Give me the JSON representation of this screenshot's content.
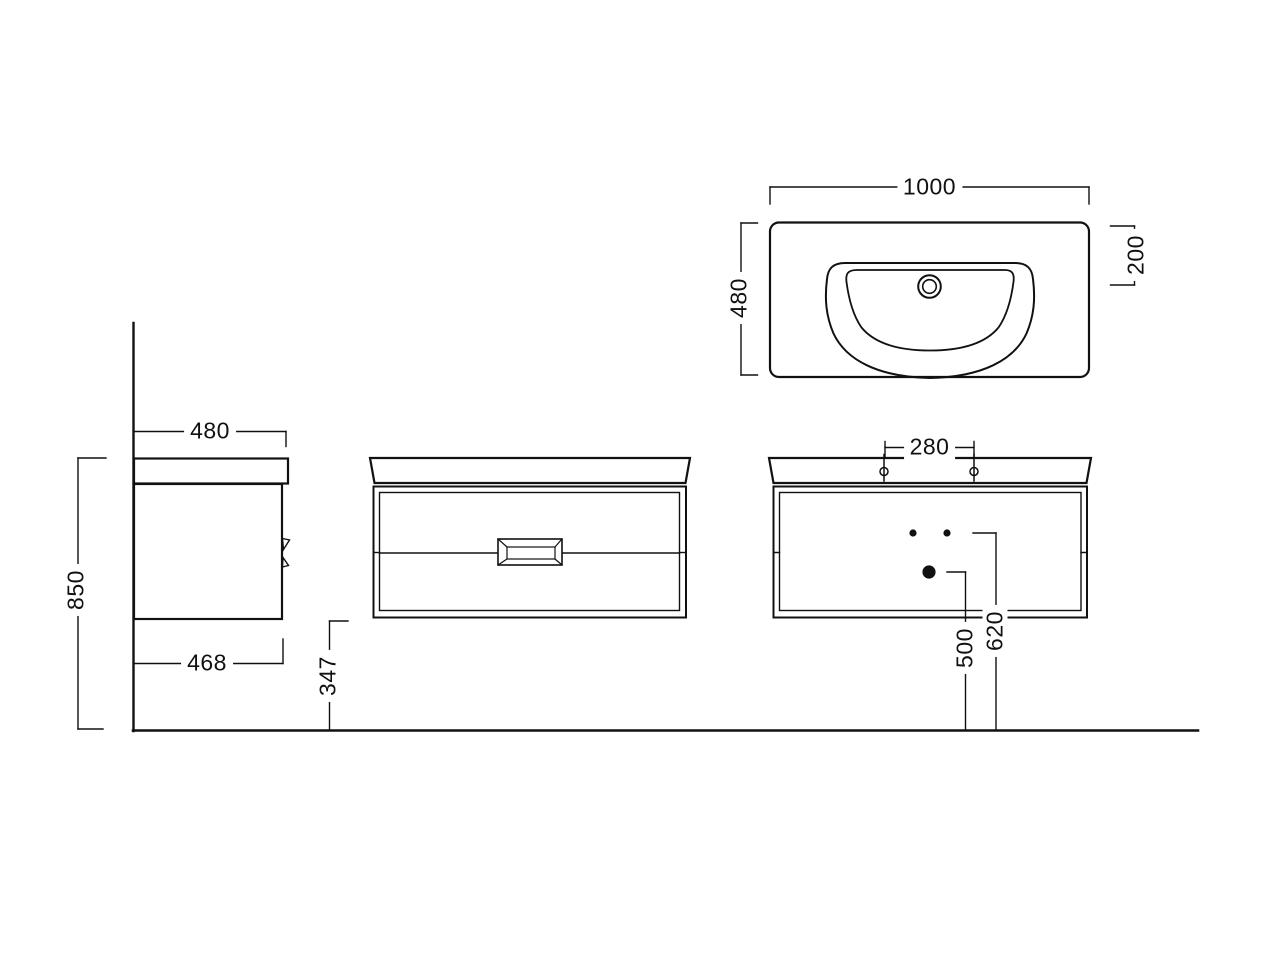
{
  "style": {
    "line_color": "#111111",
    "background": "#ffffff"
  },
  "views": {
    "plan": {
      "dim_width": "1000",
      "dim_depth": "480",
      "dim_drain_from_back": "200"
    },
    "side": {
      "dim_top_depth": "480",
      "dim_height": "850",
      "dim_cabinet_depth": "468"
    },
    "front": {
      "dim_clearance_below": "347"
    },
    "front_holes": {
      "dim_tap_spacing": "280",
      "dim_drain_height": "500",
      "dim_tap_height": "620"
    }
  }
}
